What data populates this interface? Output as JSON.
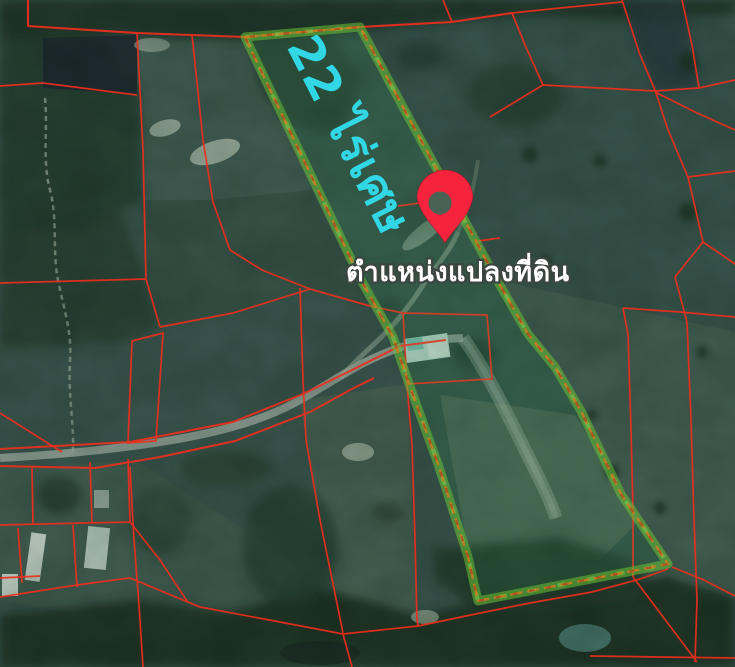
{
  "map": {
    "area_label": "22 ไร่เศษ",
    "location_label": "ตำแหน่งแปลงที่ดิน",
    "icons": {
      "pin": "location-pin-icon"
    },
    "colors": {
      "cadastral_line_red": "#ee2e1e",
      "parcel_outline_green": "#69c337",
      "parcel_outline_orange": "#c77b20",
      "area_label_cyan": "#32d7e6",
      "location_label_white": "#ffffff",
      "pin_red": "#f5243c"
    }
  }
}
